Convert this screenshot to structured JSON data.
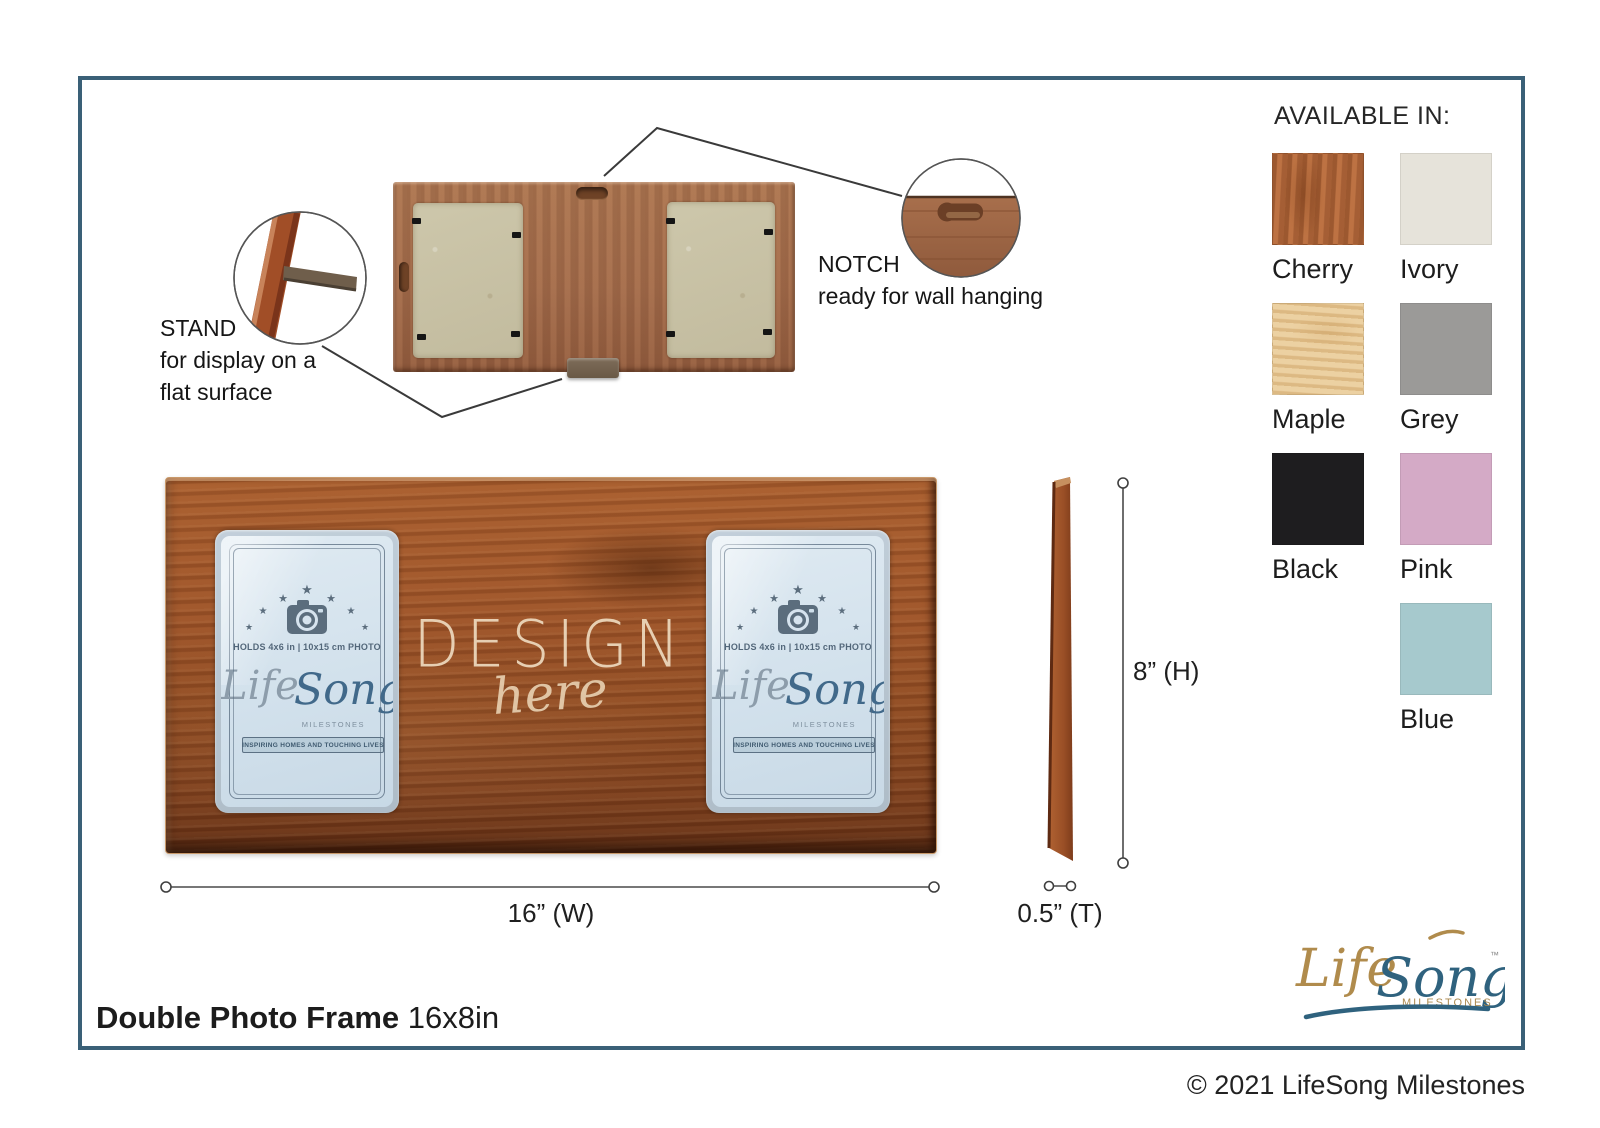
{
  "available_in": {
    "heading": "AVAILABLE IN:",
    "items": [
      {
        "name": "Cherry",
        "hex": "#b1683c",
        "texture": "wood-cherry"
      },
      {
        "name": "Ivory",
        "hex": "#e6e3da",
        "texture": "plain"
      },
      {
        "name": "Maple",
        "hex": "#e6c795",
        "texture": "wood-maple"
      },
      {
        "name": "Grey",
        "hex": "#9b9a98",
        "texture": "plain"
      },
      {
        "name": "Black",
        "hex": "#1e1d1f",
        "texture": "plain"
      },
      {
        "name": "Pink",
        "hex": "#d4aac6",
        "texture": "plain"
      },
      {
        "name": "Blue",
        "hex": "#a6c9cd",
        "texture": "plain"
      }
    ]
  },
  "callouts": {
    "stand": {
      "title": "STAND",
      "line1": "for display on a",
      "line2": "flat surface"
    },
    "notch": {
      "title": "NOTCH",
      "line1": "ready for wall hanging"
    }
  },
  "dimensions": {
    "width": "16” (W)",
    "height": "8” (H)",
    "thickness": "0.5” (T)"
  },
  "design_overlay": {
    "word": "DESIGN",
    "script": "here"
  },
  "insert_card": {
    "holds": "HOLDS 4x6 in | 10x15 cm PHOTO",
    "brand_life": "Life",
    "brand_song": "Song",
    "brand_sub": "MILESTONES",
    "tagline": "INSPIRING HOMES AND TOUCHING LIVES"
  },
  "footer": {
    "product_name": "Double Photo Frame",
    "product_size": "16x8in"
  },
  "brand_logo": {
    "life": "Life",
    "song": "Song",
    "sub": "MILESTONES",
    "tm": "™"
  },
  "copyright_line": "© 2021 LifeSong Milestones",
  "colors": {
    "border": "#3a6077",
    "front_wood": "#95502a",
    "accent_blue": "#2f627e",
    "accent_gold": "#b08b4c"
  }
}
